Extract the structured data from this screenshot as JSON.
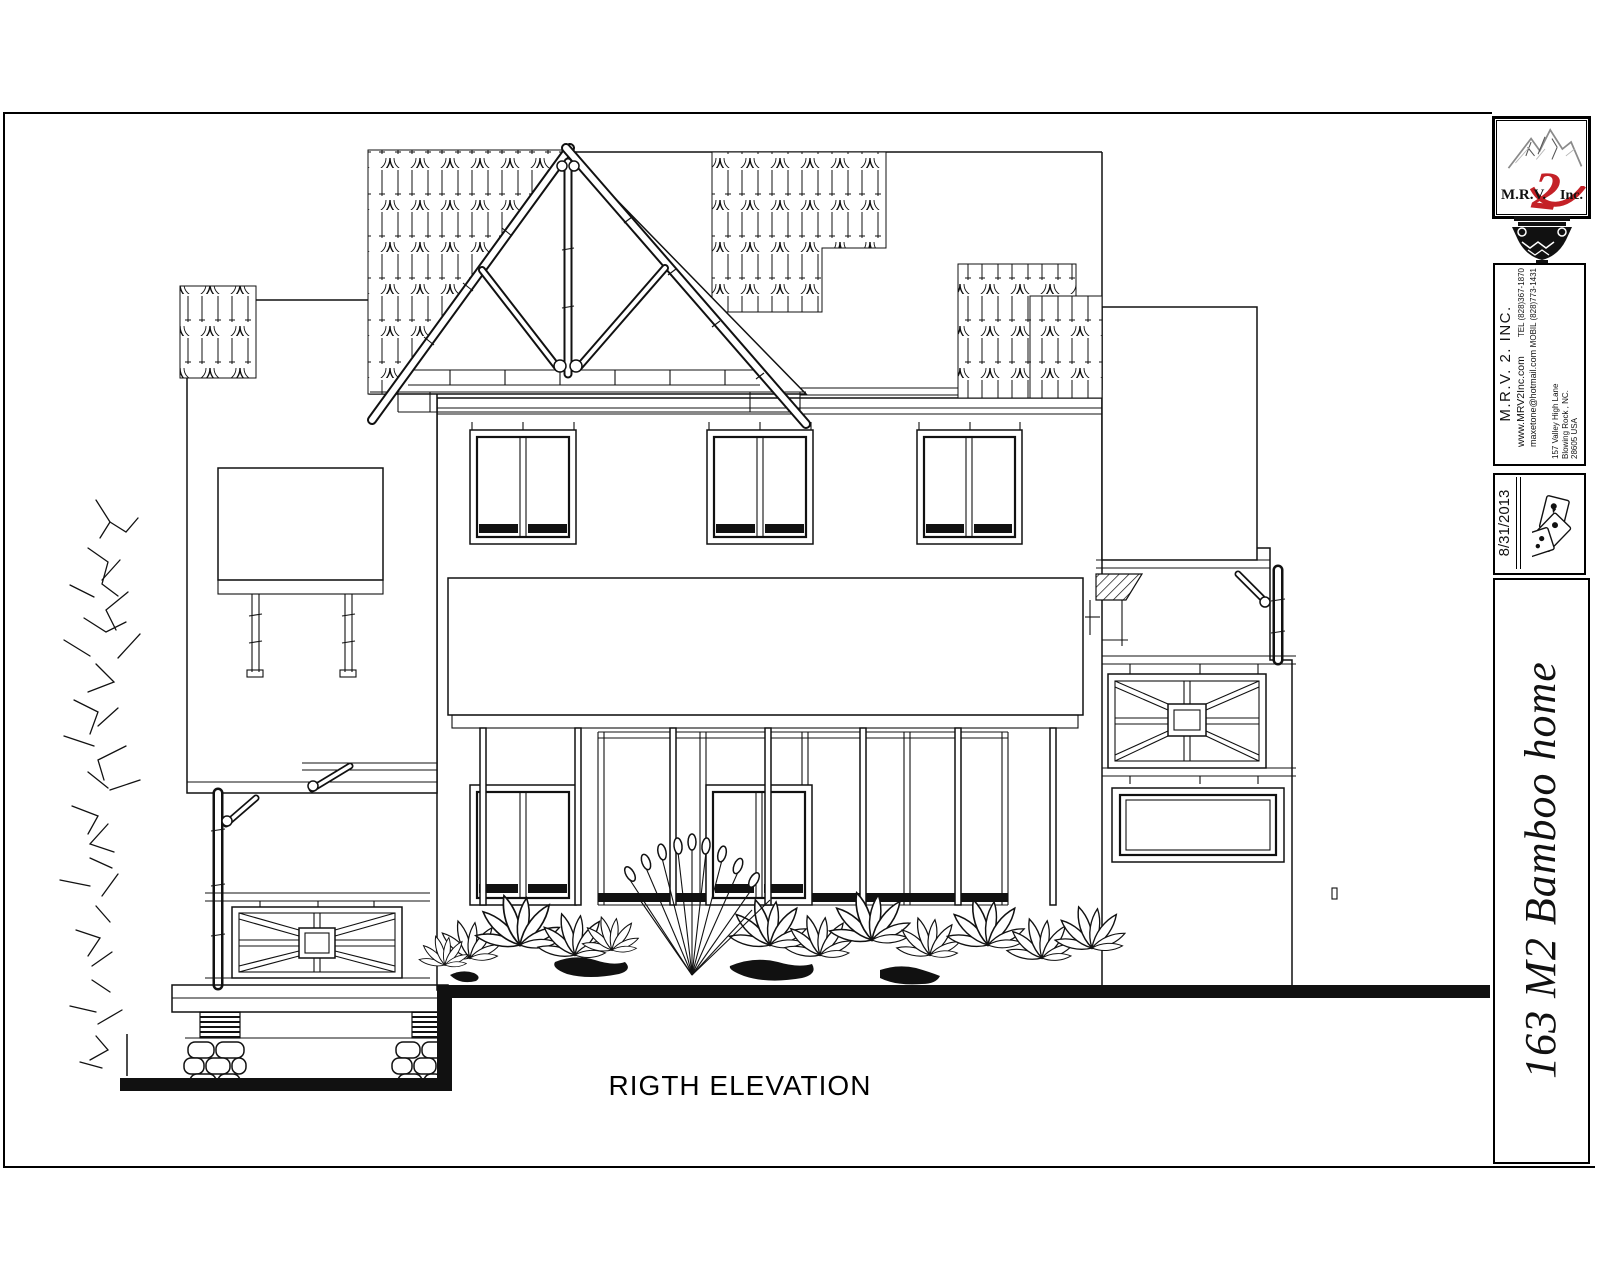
{
  "page": {
    "background": "#ffffff",
    "line_color": "#111111"
  },
  "drawing": {
    "label": "RIGTH ELEVATION"
  },
  "title_block": {
    "logo": {
      "prefix": "M.R.V.",
      "number": "2",
      "suffix": "Inc.",
      "accent_color": "#c42127"
    },
    "company": {
      "name": "M.R.V. 2. INC.",
      "website": "www.MRV2Inc.com",
      "email": "maxetone@hotmail.com",
      "tel": "TEL (828)367-1870",
      "mobil": "MOBIL (828)773-1431",
      "address_line1": "157 Valley High Lane",
      "address_line2": "Blowing Rock , NC.",
      "address_line3": "28605 USA"
    },
    "date": "8/31/2013",
    "project_title": "163 M2 Bamboo home"
  }
}
